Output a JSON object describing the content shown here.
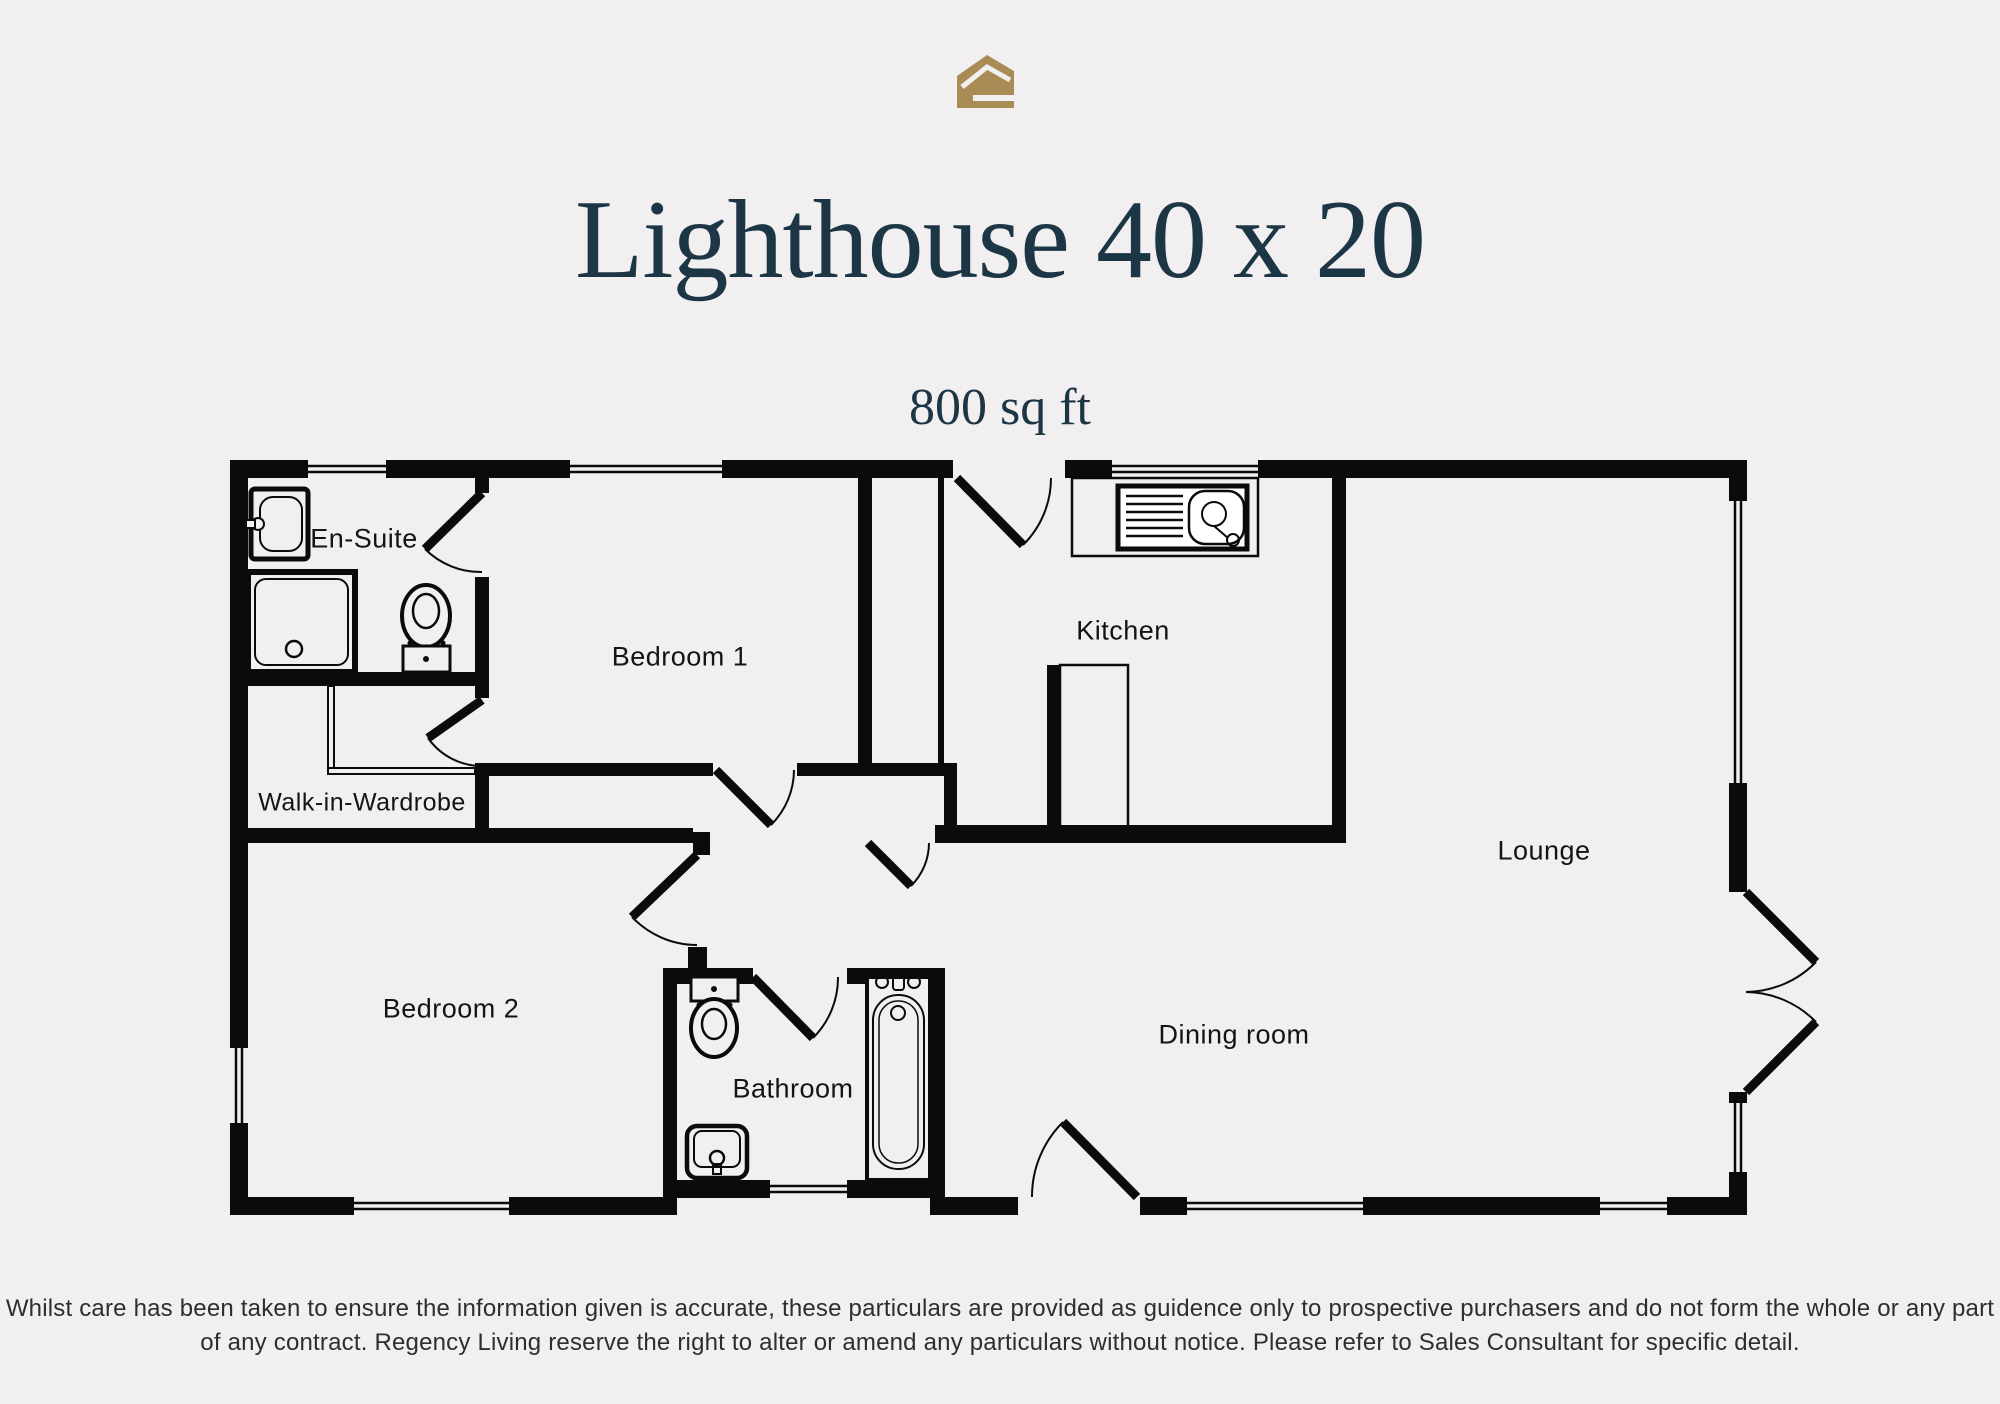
{
  "header": {
    "title": "Lighthouse 40 x 20",
    "subtitle": "800 sq ft"
  },
  "branding": {
    "logo_icon": "gold-house-logo",
    "logo_color": "#a98c55"
  },
  "colors": {
    "background": "#f1eff0",
    "walls": "#0b0b0b",
    "title_text": "#1c3645"
  },
  "floorplan": {
    "rooms": [
      {
        "id": "en-suite",
        "label": "En-Suite"
      },
      {
        "id": "bedroom-1",
        "label": "Bedroom 1"
      },
      {
        "id": "kitchen",
        "label": "Kitchen"
      },
      {
        "id": "walk-in-wardrobe",
        "label": "Walk-in-Wardrobe"
      },
      {
        "id": "lounge",
        "label": "Lounge"
      },
      {
        "id": "bedroom-2",
        "label": "Bedroom 2"
      },
      {
        "id": "bathroom",
        "label": "Bathroom"
      },
      {
        "id": "dining-room",
        "label": "Dining room"
      }
    ],
    "fixture_icons": [
      "basin-icon",
      "shower-icon",
      "toilet-icon",
      "kitchen-sink-icon",
      "bath-icon",
      "french-doors-icon"
    ]
  },
  "footer": {
    "lines": [
      "Whilst care has been taken to ensure the information given is accurate, these particulars are provided as guidence only to prospective purchasers and do not form the whole or any part",
      "of any contract. Regency Living reserve the right to alter or amend any particulars without notice. Please refer to Sales Consultant for specific detail."
    ]
  }
}
